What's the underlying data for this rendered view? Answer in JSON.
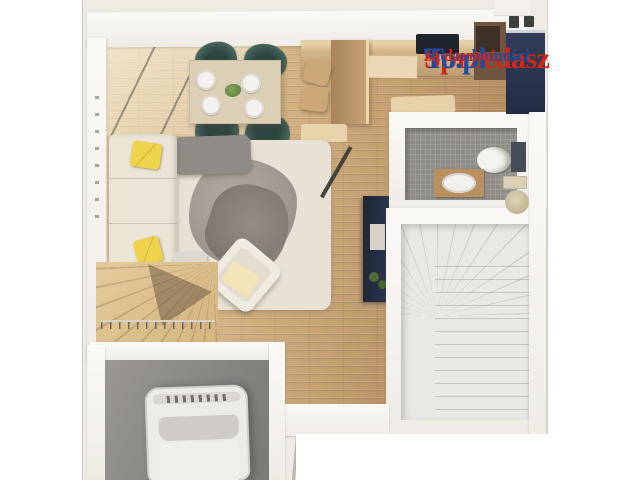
{
  "watermark": {
    "brand_first": "Sprzedasz",
    "brand_second": "To.pl",
    "tagline_first": "Nieruchomości",
    "tagline_second": "za darmo!"
  },
  "palette": {
    "watermark-red": "#d02517",
    "watermark-blue": "#1e4da0",
    "photo-bg": "#eeebe5",
    "wood-light": "#e3c795",
    "wood-dark": "#a98355",
    "tile-gray": "#918e88",
    "navy": "#2c3750",
    "chair-teal": "#3e5a54",
    "rug-cream": "#e8e2d6",
    "sofa-cream": "#ebe5d8",
    "pillow-yellow": "#eed44d",
    "stair-wood": "#e5cb9c",
    "stair-floor": "#eae8e4",
    "garage-gray": "#868481",
    "car-white": "#edebe7"
  }
}
